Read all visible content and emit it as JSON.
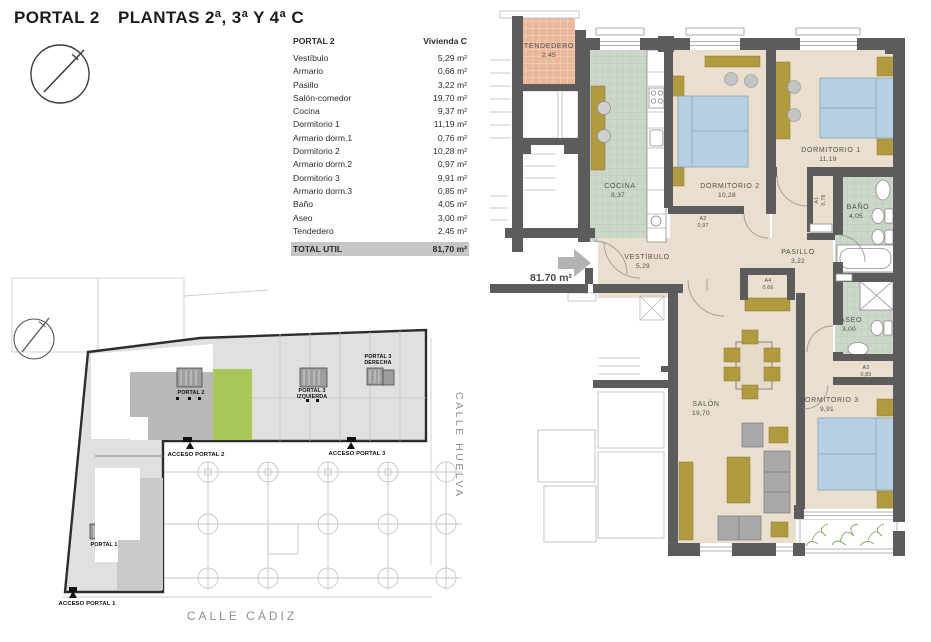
{
  "title": {
    "portal": "PORTAL 2",
    "plantas": "PLANTAS 2ª, 3ª Y 4ª C"
  },
  "area_table": {
    "header": {
      "portal": "PORTAL 2",
      "vivienda": "Vivienda C"
    },
    "rows": [
      {
        "label": "Vestíbulo",
        "value": "5,29 m²"
      },
      {
        "label": "Armario",
        "value": "0,66 m²"
      },
      {
        "label": "Pasillo",
        "value": "3,22 m²"
      },
      {
        "label": "Salón-comedor",
        "value": "19,70 m²"
      },
      {
        "label": "Cocina",
        "value": "9,37 m²"
      },
      {
        "label": "Dormitorio 1",
        "value": "11,19 m²"
      },
      {
        "label": "Armario dorm.1",
        "value": "0,76 m²"
      },
      {
        "label": "Dormitorio 2",
        "value": "10,28 m²"
      },
      {
        "label": "Armario dorm.2",
        "value": "0,97 m²"
      },
      {
        "label": "Dormitorio 3",
        "value": "9,91 m²"
      },
      {
        "label": "Armario dorm.3",
        "value": "0,85 m²"
      },
      {
        "label": "Baño",
        "value": "4,05 m²"
      },
      {
        "label": "Aseo",
        "value": "3,00 m²"
      },
      {
        "label": "Tendedero",
        "value": "2,45 m²"
      }
    ],
    "total": {
      "label": "TOTAL UTIL",
      "value": "81,70 m²"
    }
  },
  "floor_plan": {
    "entry_area_label": "81.70 m²",
    "rooms": {
      "tendedero": {
        "name": "TENDEDERO",
        "area": "2,45"
      },
      "cocina": {
        "name": "COCINA",
        "area": "9,37"
      },
      "dormitorio_2": {
        "name": "DORMITORIO 2",
        "area": "10,28"
      },
      "dormitorio_1": {
        "name": "DORMITORIO 1",
        "area": "11,19"
      },
      "bano": {
        "name": "BAÑO",
        "area": "4,05"
      },
      "aseo": {
        "name": "ASEO",
        "area": "3,00"
      },
      "pasillo": {
        "name": "PASILLO",
        "area": "3,22"
      },
      "vestibulo": {
        "name": "VESTÍBULO",
        "area": "5,29"
      },
      "salon": {
        "name": "SALÓN",
        "area": "19,70"
      },
      "dormitorio_3": {
        "name": "DORMITORIO 3",
        "area": "9,91"
      },
      "armario_1": {
        "name": "A1",
        "area": "0,76"
      },
      "armario_2": {
        "name": "A2",
        "area": "0,97"
      },
      "armario_3": {
        "name": "A3",
        "area": "0,85"
      },
      "armario_4": {
        "name": "A4",
        "area": "0,66"
      }
    }
  },
  "site_plan": {
    "portals": {
      "portal2": "PORTAL 2",
      "portal3": "PORTAL 3",
      "portal3_izquierda": "IZQUIERDA",
      "portal3_derecha": "DERECHA",
      "portal1": "PORTAL 1"
    },
    "accesses": {
      "acceso1": "ACCESO PORTAL 1",
      "acceso2": "ACCESO PORTAL 2",
      "acceso3": "ACCESO PORTAL 3"
    },
    "streets": {
      "calle_cadiz": "CALLE CÁDIZ",
      "calle_huelva": "CALLE HUELVA"
    }
  },
  "colors": {
    "wall": "#5c5c5c",
    "floor_beige": "#eadfce",
    "kitchen_bath_green": "#cbd7c8",
    "tendedero_salmon": "#eab79a",
    "bed_blue": "#b6cfe3",
    "furniture_olive": "#b09b41",
    "highlight_unit_green": "#a9c659",
    "total_row_bg": "#c6c6c6"
  }
}
